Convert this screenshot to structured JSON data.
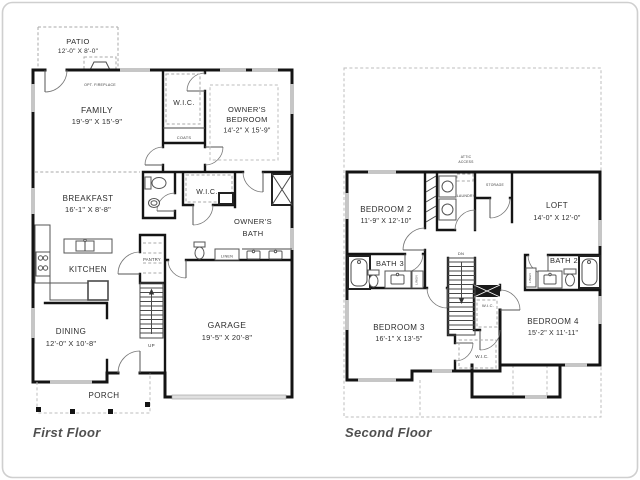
{
  "page": {
    "background": "#ffffff",
    "border_color": "#cfcfcf",
    "wall_color": "#141414",
    "window_color": "#c6c6c6"
  },
  "first_floor": {
    "title": "First Floor",
    "patio": {
      "name": "PATIO",
      "dims": "12'-0\" X 8'-0\""
    },
    "opt_fireplace": {
      "name": "OPT. FIREPLACE"
    },
    "family": {
      "name": "FAMILY",
      "dims": "19'-9\" X 15'-9\""
    },
    "wic_upper": {
      "name": "W.I.C."
    },
    "coats": {
      "name": "COATS"
    },
    "owners_bedroom": {
      "line1": "OWNER'S",
      "line2": "BEDROOM",
      "dims": "14'-2\" X 15'-9\""
    },
    "breakfast": {
      "name": "BREAKFAST",
      "dims": "16'-1\" X 8'-8\""
    },
    "wic_hall": {
      "name": "W.I.C."
    },
    "owners_bath": {
      "line1": "OWNER'S",
      "line2": "BATH"
    },
    "linen": {
      "name": "LINEN"
    },
    "pantry": {
      "name": "PANTRY"
    },
    "kitchen": {
      "name": "KITCHEN"
    },
    "stairs": {
      "label": "UP"
    },
    "dining": {
      "name": "DINING",
      "dims": "12'-0\" X 10'-8\""
    },
    "garage": {
      "name": "GARAGE",
      "dims": "19'-5\" X 20'-8\""
    },
    "porch": {
      "name": "PORCH"
    }
  },
  "second_floor": {
    "title": "Second Floor",
    "attic_access": {
      "line1": "ATTIC",
      "line2": "ACCESS"
    },
    "bedroom2": {
      "name": "BEDROOM 2",
      "dims": "11'-9\" X 12'-10\""
    },
    "laundry": {
      "name": "LAUNDRY"
    },
    "storage": {
      "name": "STORAGE"
    },
    "loft": {
      "name": "LOFT",
      "dims": "14'-0\" X 12'-0\""
    },
    "bath3": {
      "name": "BATH 3"
    },
    "bath3_linen": {
      "name": "LINEN"
    },
    "stairs": {
      "label": "DN"
    },
    "bath2": {
      "name": "BATH 2"
    },
    "bath2_linen": {
      "name": "LINEN"
    },
    "wic_upper": {
      "name": "W.I.C."
    },
    "wic_lower": {
      "name": "W.I.C."
    },
    "bedroom3": {
      "name": "BEDROOM 3",
      "dims": "16'-1\" X 13'-5\""
    },
    "bedroom4": {
      "name": "BEDROOM 4",
      "dims": "15'-2\" X 11'-11\""
    }
  }
}
